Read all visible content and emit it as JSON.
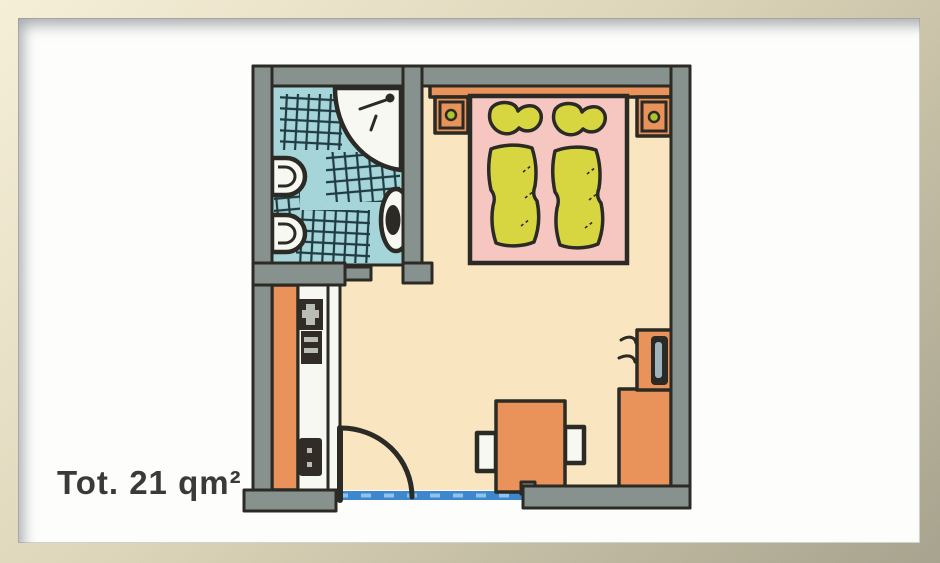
{
  "caption": {
    "text": "Tot. 21 qm²"
  },
  "colors": {
    "frame_light": "#f6efd8",
    "frame_mid": "#ddd5b9",
    "frame_dark": "#a8a38e",
    "mat_white": "#fdfdfc",
    "wall_gray": "#87918e",
    "outline_dark": "#2b2a25",
    "bath_floor_blue": "#a6d5d9",
    "tile_line_teal": "#1e3c42",
    "room_floor_cream": "#f9e5bf",
    "bed_pink": "#f5c7c0",
    "linen_yellow": "#d8d640",
    "furniture_orange": "#e9925a",
    "fixture_white": "#f7f8f2",
    "window_blue": "#3e87cc",
    "window_dash_blue": "#8fc3ea",
    "lamp_green": "#adc42f",
    "dark_brown": "#322c26",
    "screen_gray": "#9fb3ba",
    "caption_dark": "#3a3a3a"
  },
  "plan": {
    "type": "hotel-room-floor-plan",
    "rooms": [
      "bathroom",
      "bedroom"
    ],
    "objects": [
      "shower",
      "bidet",
      "toilet",
      "sink",
      "double-bed",
      "pillows",
      "duvets",
      "headboard",
      "nightstands",
      "bedside-lamps",
      "wardrobe",
      "minibar",
      "entrance-door",
      "window",
      "armchair",
      "tv",
      "tv-cabinet"
    ]
  }
}
